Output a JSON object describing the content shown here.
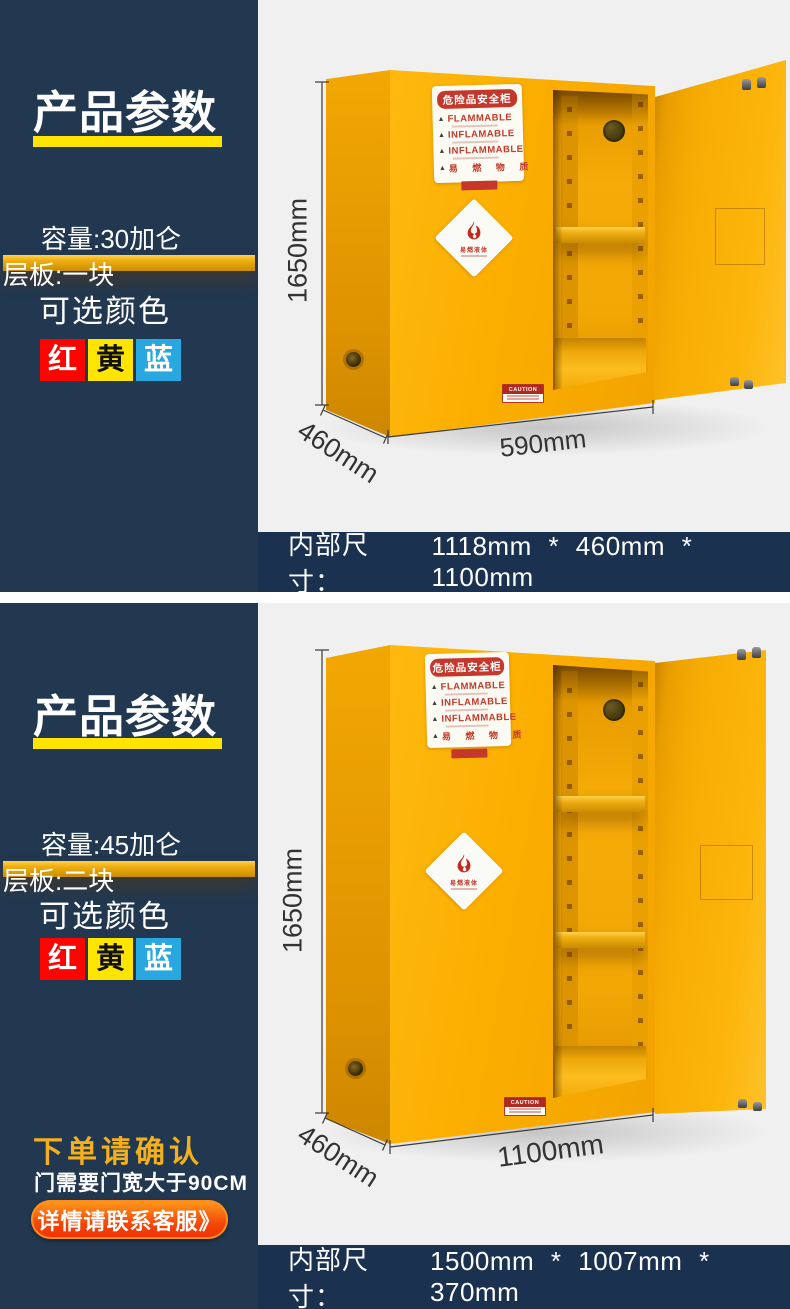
{
  "theme": {
    "panel_bg": "#223850",
    "bar_bg": "#1B3150",
    "photo_bg": "#F0F0F1",
    "accent_yellow": "#FFE400",
    "cabinet_yellow": "#FBAE00",
    "label_red": "#C5372B",
    "order_title_gold": "#F2B01E",
    "button_gradient": [
      "#FF9D1B",
      "#EE2F00"
    ]
  },
  "icons": {
    "warning_triangle": "▲"
  },
  "sections": [
    {
      "title": "产品参数",
      "spec_capacity": "容量:30加仑",
      "spec_shelf": "层板:一块",
      "color_label": "可选颜色",
      "color_options": [
        {
          "label": "红",
          "hex": "#FB0500"
        },
        {
          "label": "黄",
          "hex": "#FFE400"
        },
        {
          "label": "蓝",
          "hex": "#28A7E1"
        }
      ],
      "dim_height": "1650mm",
      "dim_depth": "460mm",
      "dim_width": "590mm",
      "inner_label": "内部尺寸：",
      "inner_value": "1118mm * 460mm * 1100mm",
      "cabinet_label": {
        "header": "危险品安全柜",
        "line1": "FLAMMABLE",
        "line2": "INFLAMABLE",
        "line3": "INFLAMMABLE",
        "line4": "易 燃 物 质"
      },
      "diamond_text": "易燃液体",
      "caution_text": "CAUTION"
    },
    {
      "title": "产品参数",
      "spec_capacity": "容量:45加仑",
      "spec_shelf": "层板:二块",
      "color_label": "可选颜色",
      "color_options": [
        {
          "label": "红",
          "hex": "#FB0500"
        },
        {
          "label": "黄",
          "hex": "#FFE400"
        },
        {
          "label": "蓝",
          "hex": "#28A7E1"
        }
      ],
      "dim_height": "1650mm",
      "dim_depth": "460mm",
      "dim_width": "1100mm",
      "inner_label": "内部尺寸：",
      "inner_value": "1500mm * 1007mm * 370mm",
      "cabinet_label": {
        "header": "危险品安全柜",
        "line1": "FLAMMABLE",
        "line2": "INFLAMABLE",
        "line3": "INFLAMMABLE",
        "line4": "易 燃 物 质"
      },
      "diamond_text": "易燃液体",
      "caution_text": "CAUTION"
    }
  ],
  "order_note": {
    "title": "下单请确认",
    "subtitle": "门需要门宽大于90CM",
    "button": "详情请联系客服》"
  }
}
